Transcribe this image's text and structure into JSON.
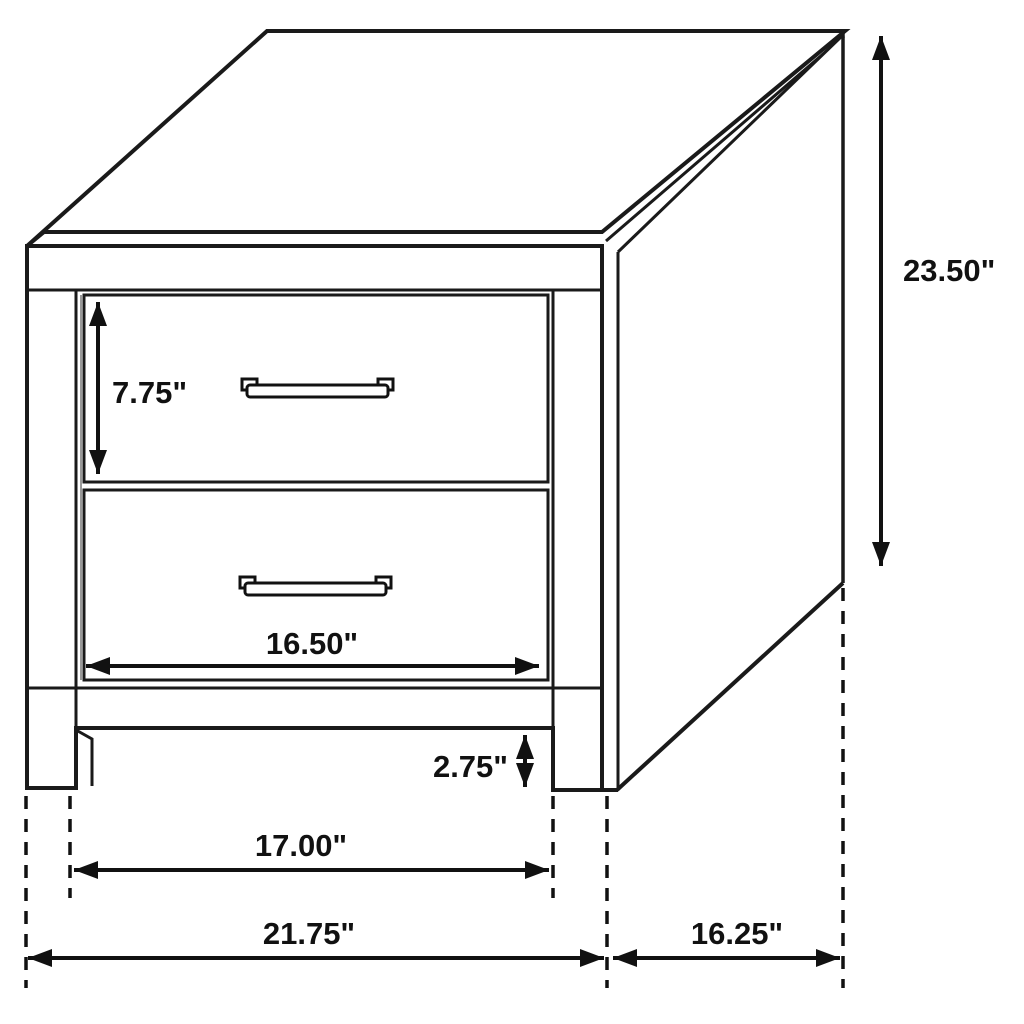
{
  "diagram": {
    "title": "2-drawer nightstand dimension diagram",
    "type": "isometric line drawing with dimension annotations",
    "units": "inches",
    "colors": {
      "line": "#1a1a1a",
      "dimension": "#111111",
      "background": "#ffffff"
    },
    "dimensions": [
      {
        "id": "overall-height",
        "label": "23.50\"",
        "orientation": "vertical",
        "measures": "overall height"
      },
      {
        "id": "top-drawer-height",
        "label": "7.75\"",
        "orientation": "vertical",
        "measures": "top drawer opening height"
      },
      {
        "id": "drawer-width",
        "label": "16.50\"",
        "orientation": "horizontal",
        "measures": "drawer front width"
      },
      {
        "id": "leg-height",
        "label": "2.75\"",
        "orientation": "vertical",
        "measures": "leg height"
      },
      {
        "id": "inner-leg-span",
        "label": "17.00\"",
        "orientation": "horizontal",
        "measures": "span between legs"
      },
      {
        "id": "overall-width",
        "label": "21.75\"",
        "orientation": "horizontal",
        "measures": "overall width"
      },
      {
        "id": "overall-depth",
        "label": "16.25\"",
        "orientation": "horizontal",
        "measures": "overall depth"
      }
    ]
  }
}
